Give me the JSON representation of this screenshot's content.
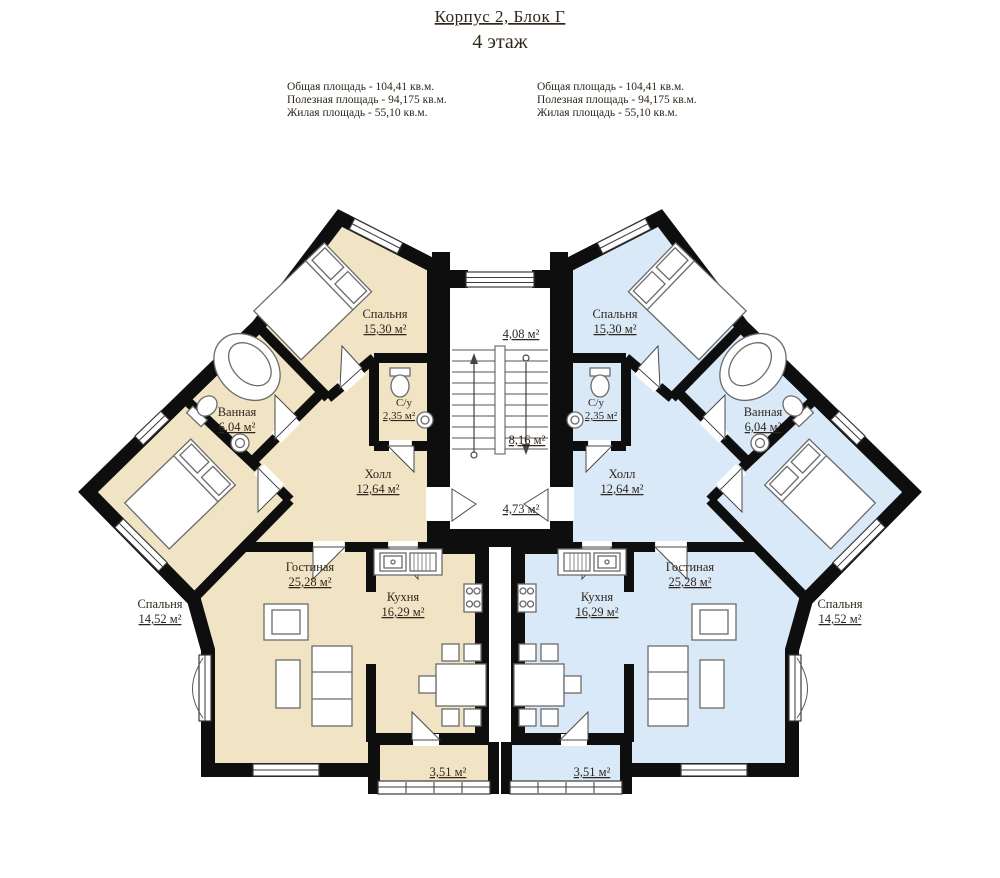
{
  "title": "Корпус 2, Блок Г",
  "subtitle": "4 этаж",
  "summary_left": {
    "total": "Общая площадь - 104,41 кв.м.",
    "usable": "Полезная площадь - 94,175 кв.м.",
    "living": "Жилая площадь - 55,10 кв.м."
  },
  "summary_right": {
    "total": "Общая площадь - 104,41 кв.м.",
    "usable": "Полезная площадь - 94,175 кв.м.",
    "living": "Жилая площадь - 55,10 кв.м."
  },
  "stairwell": {
    "upper_landing_area": "4,08 м²",
    "flight_area": "8,16 м²",
    "lower_landing_area": "4,73 м²"
  },
  "colors": {
    "left_apartment_fill": "#f0e4c4",
    "right_apartment_fill": "#d9e9f8",
    "walls": "#0e0e0e"
  },
  "left_apartment": {
    "bedroom_top": {
      "name": "Спальня",
      "area": "15,30 м²"
    },
    "bathroom": {
      "name": "Ванная",
      "area": "6,04 м²"
    },
    "wc": {
      "name": "С/у",
      "area": "2,35 м²"
    },
    "hall": {
      "name": "Холл",
      "area": "12,64 м²"
    },
    "bedroom_bottom": {
      "name": "Спальня",
      "area": "14,52 м²"
    },
    "living_room": {
      "name": "Гостиная",
      "area": "25,28 м²"
    },
    "kitchen": {
      "name": "Кухня",
      "area": "16,29 м²"
    },
    "balcony": {
      "area": "3,51 м²"
    }
  },
  "right_apartment": {
    "bedroom_top": {
      "name": "Спальня",
      "area": "15,30 м²"
    },
    "bathroom": {
      "name": "Ванная",
      "area": "6,04 м²"
    },
    "wc": {
      "name": "С/у",
      "area": "2,35 м²"
    },
    "hall": {
      "name": "Холл",
      "area": "12,64 м²"
    },
    "bedroom_bottom": {
      "name": "Спальня",
      "area": "14,52 м²"
    },
    "living_room": {
      "name": "Гостиная",
      "area": "25,28 м²"
    },
    "kitchen": {
      "name": "Кухня",
      "area": "16,29 м²"
    },
    "balcony": {
      "area": "3,51 м²"
    }
  }
}
